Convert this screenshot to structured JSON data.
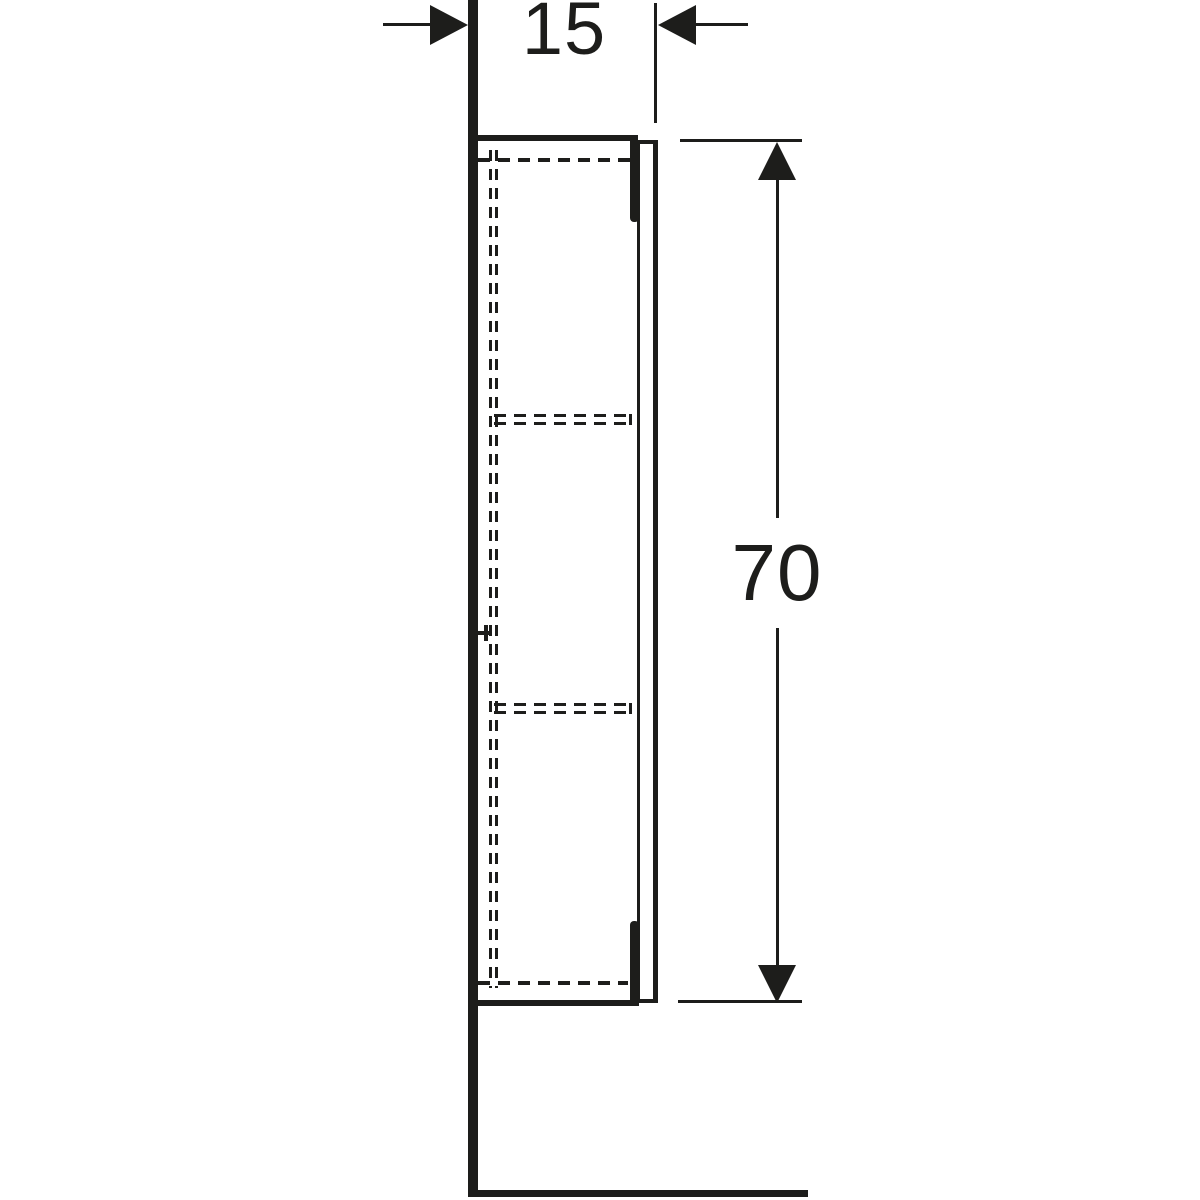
{
  "drawing": {
    "line_color": "#1d1d1b",
    "background_color": "#ffffff",
    "dimensions": {
      "depth": {
        "label": "15"
      },
      "height": {
        "label": "70"
      }
    }
  }
}
